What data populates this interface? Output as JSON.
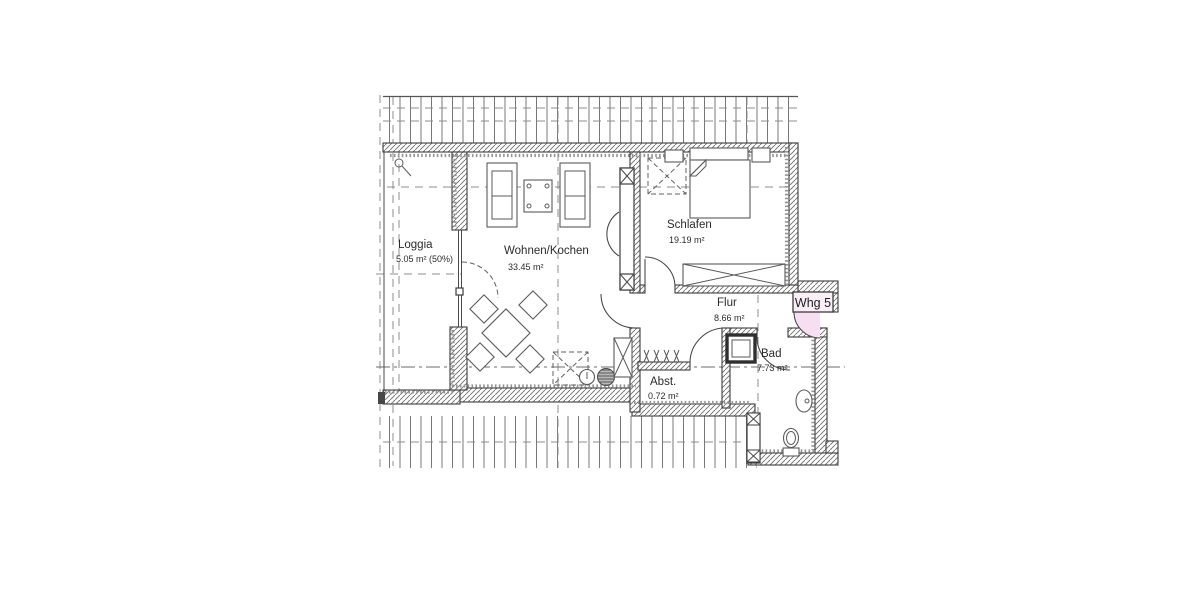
{
  "plan": {
    "unit_label": "Whg 5",
    "rooms": {
      "loggia": {
        "name": "Loggia",
        "area": "5.05 m² (50%)"
      },
      "wohnen": {
        "name": "Wohnen/Kochen",
        "area": "33.45 m²"
      },
      "schlafen": {
        "name": "Schlafen",
        "area": "19.19 m²"
      },
      "flur": {
        "name": "Flur",
        "area": "8.66 m²"
      },
      "bad": {
        "name": "Bad",
        "area": "7.73 m²"
      },
      "abstellraum": {
        "name": "Abst.",
        "area": "0.72 m²"
      }
    },
    "colors": {
      "line": "#3c3c3c",
      "hatch": "#6e6e6e",
      "roof_line": "#787878",
      "entry_highlight": "#f6dff0",
      "entry_box_fill": "#fbeff7",
      "background": "#ffffff"
    }
  }
}
